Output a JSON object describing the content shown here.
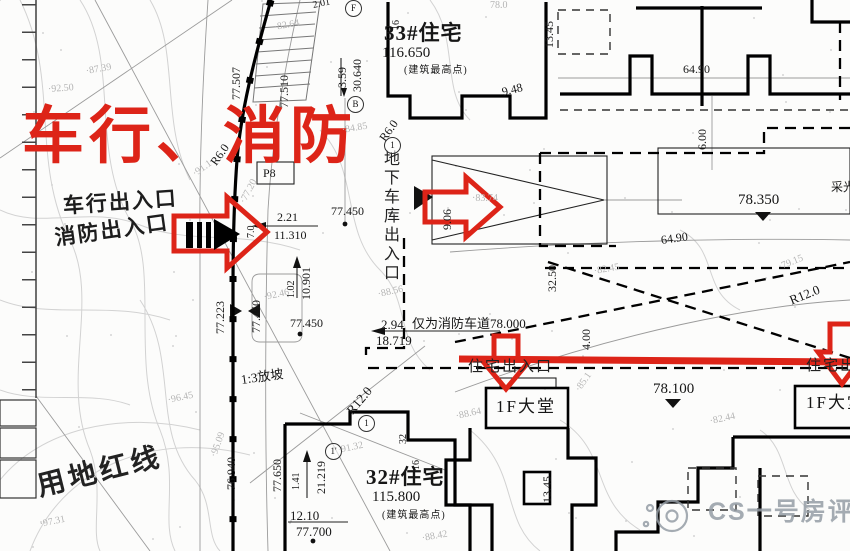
{
  "colors": {
    "accent_red": "#dd2418",
    "ink": "#111111",
    "faint_gray": "#b5b5b5",
    "contour_gray": "#d2d2d2",
    "watermark_gray": "#949ca4"
  },
  "labels": [
    {
      "n": "headline-vehicle-fire",
      "t": "车行、消防",
      "x": 22,
      "y": 106,
      "c": "red-head"
    },
    {
      "n": "note-vehicle-entrance",
      "t": "车行出入口",
      "x": 63,
      "y": 196,
      "c": "cn-hand",
      "r": -4
    },
    {
      "n": "note-fire-entrance",
      "t": "消防出入口",
      "x": 55,
      "y": 228,
      "c": "cn-hand",
      "r": -8
    },
    {
      "n": "building-33-title",
      "t": "33#住宅",
      "x": 384,
      "y": 23,
      "c": "title"
    },
    {
      "n": "building-33-elevation",
      "t": "116.650",
      "x": 382,
      "y": 46,
      "c": "dim-lg"
    },
    {
      "n": "building-33-note",
      "t": "(建筑最高点)",
      "x": 404,
      "y": 66,
      "c": "cn-s"
    },
    {
      "n": "building-32-title",
      "t": "32#住宅",
      "x": 366,
      "y": 467,
      "c": "title"
    },
    {
      "n": "building-32-elevation",
      "t": "115.800",
      "x": 372,
      "y": 490,
      "c": "dim-lg"
    },
    {
      "n": "building-32-note",
      "t": "(建筑最高点)",
      "x": 382,
      "y": 511,
      "c": "cn-s"
    },
    {
      "n": "lobby-left-label",
      "t": "1F大堂",
      "x": 496,
      "y": 398,
      "c": "cn-lobby"
    },
    {
      "n": "lobby-right-label",
      "t": "1F大堂",
      "x": 806,
      "y": 394,
      "c": "cn-lobby"
    },
    {
      "n": "residential-entrance-left",
      "t": "住宅出入口",
      "x": 468,
      "y": 360,
      "c": "cn-entry"
    },
    {
      "n": "residential-entrance-right",
      "t": "住宅出入口",
      "x": 806,
      "y": 359,
      "c": "cn-entry"
    },
    {
      "n": "garage-entrance-label",
      "t": "地下车库出入口",
      "x": 381,
      "y": 150,
      "c": "cn-vert"
    },
    {
      "n": "fire-lane-note",
      "t": "仅为消防车道78.000",
      "x": 412,
      "y": 317,
      "c": "dim-m"
    },
    {
      "n": "dim-2-94",
      "t": "2.94",
      "x": 381,
      "y": 318,
      "c": "dim-m"
    },
    {
      "n": "dim-18-719",
      "t": "18.719",
      "x": 376,
      "y": 334,
      "c": "dim-m"
    },
    {
      "n": "spot-77-450-a",
      "t": "77.450",
      "x": 331,
      "y": 205,
      "c": "dim"
    },
    {
      "n": "dim-2-21",
      "t": "2.21",
      "x": 277,
      "y": 211,
      "c": "dim"
    },
    {
      "n": "dim-11-310",
      "t": "11.310",
      "x": 274,
      "y": 229,
      "c": "dim"
    },
    {
      "n": "spot-77-450-b",
      "t": "77.450",
      "x": 290,
      "y": 317,
      "c": "dim"
    },
    {
      "n": "spot-78-350",
      "t": "78.350",
      "x": 738,
      "y": 193,
      "c": "dim-lg"
    },
    {
      "n": "spot-78-100",
      "t": "78.100",
      "x": 653,
      "y": 382,
      "c": "dim-lg"
    },
    {
      "n": "dim-64-90-top",
      "t": "64.90",
      "x": 683,
      "y": 63,
      "c": "dim"
    },
    {
      "n": "dim-64-90-mid",
      "t": "64.90",
      "x": 661,
      "y": 234,
      "c": "dim",
      "r": -8
    },
    {
      "n": "label-daylight-well",
      "t": "采光",
      "x": 831,
      "y": 181,
      "c": "cn-s2"
    },
    {
      "n": "dim-9-48",
      "t": "9.48",
      "x": 502,
      "y": 86,
      "c": "dim",
      "r": -14
    },
    {
      "n": "contour-78-0",
      "t": "78.0",
      "x": 490,
      "y": 1,
      "c": "faint"
    },
    {
      "n": "dim-2-01",
      "t": "2.01",
      "x": 313,
      "y": 1,
      "c": "dim-s",
      "r": -12
    },
    {
      "n": "label-p8",
      "t": "P8",
      "x": 263,
      "y": 167,
      "c": "dim"
    },
    {
      "n": "radius-r6-road",
      "t": "R6.0",
      "x": 213,
      "y": 158,
      "c": "dim",
      "r": -55
    },
    {
      "n": "radius-r6-upper",
      "t": "R6.0",
      "x": 382,
      "y": 134,
      "c": "dim",
      "r": -55
    },
    {
      "n": "slope-note",
      "t": "1:3放坡",
      "x": 241,
      "y": 373,
      "c": "cn-m",
      "r": -8
    },
    {
      "n": "radius-r12-left",
      "t": "R12.0",
      "x": 349,
      "y": 406,
      "c": "dim-m",
      "r": -50
    },
    {
      "n": "radius-r12-right",
      "t": "R12.0",
      "x": 790,
      "y": 294,
      "c": "dim-m",
      "r": -22
    },
    {
      "n": "land-red-line-label",
      "t": "用地红线",
      "x": 38,
      "y": 474,
      "c": "cn-big",
      "r": -14
    },
    {
      "n": "dim-12-10",
      "t": "12.10",
      "x": 290,
      "y": 509,
      "c": "dim-m"
    },
    {
      "n": "spot-77-700",
      "t": "77.700",
      "x": 296,
      "y": 525,
      "c": "dim-m"
    },
    {
      "n": "watermark-text",
      "t": "CS一号房评",
      "x": 708,
      "y": 500,
      "c": "wm"
    },
    {
      "n": "contour-82-64",
      "t": "·82.64",
      "x": 274,
      "y": 23,
      "c": "faint",
      "r": -10
    },
    {
      "n": "contour-87-39",
      "t": "·87.39",
      "x": 86,
      "y": 67,
      "c": "faint",
      "r": -10
    },
    {
      "n": "contour-92-50",
      "t": "·92.50",
      "x": 48,
      "y": 85,
      "c": "faint",
      "r": -4
    },
    {
      "n": "contour-91-1",
      "t": "·91.1",
      "x": 194,
      "y": 170,
      "c": "faint",
      "r": -35
    },
    {
      "n": "contour-84-85",
      "t": "·84.85",
      "x": 342,
      "y": 126,
      "c": "faint",
      "r": -10
    },
    {
      "n": "contour-83-74",
      "t": "·83.74",
      "x": 472,
      "y": 194,
      "c": "faint"
    },
    {
      "n": "contour-82-45",
      "t": "·82.45",
      "x": 594,
      "y": 267,
      "c": "faint",
      "r": -10
    },
    {
      "n": "contour-79-15",
      "t": "·79.15",
      "x": 779,
      "y": 263,
      "c": "faint",
      "r": -22
    },
    {
      "n": "contour-88-56",
      "t": "·88.56",
      "x": 378,
      "y": 290,
      "c": "faint",
      "r": -12
    },
    {
      "n": "contour-92-46",
      "t": "·92.46",
      "x": 264,
      "y": 293,
      "c": "faint",
      "r": -12
    },
    {
      "n": "contour-96-45",
      "t": "·96.45",
      "x": 168,
      "y": 396,
      "c": "faint",
      "r": -12
    },
    {
      "n": "contour-97-31",
      "t": "·97.31",
      "x": 40,
      "y": 520,
      "c": "faint",
      "r": -12
    },
    {
      "n": "contour-95-09",
      "t": "·95.09",
      "x": 214,
      "y": 452,
      "c": "faint",
      "r": -70
    },
    {
      "n": "contour-91-32",
      "t": "·91.32",
      "x": 338,
      "y": 446,
      "c": "faint",
      "r": -12
    },
    {
      "n": "contour-88-42",
      "t": "·88.42",
      "x": 422,
      "y": 534,
      "c": "faint",
      "r": -10
    },
    {
      "n": "contour-85-1",
      "t": "·85.1",
      "x": 578,
      "y": 386,
      "c": "faint",
      "r": -55
    },
    {
      "n": "contour-88-64",
      "t": "·88.64",
      "x": 456,
      "y": 412,
      "c": "faint",
      "r": -12
    },
    {
      "n": "contour-82-44",
      "t": "·82.44",
      "x": 710,
      "y": 417,
      "c": "faint",
      "r": -12
    },
    {
      "n": "contour-77-20",
      "t": "·77.20",
      "x": 243,
      "y": 198,
      "c": "faint",
      "r": -62
    },
    {
      "n": "dim-77-507",
      "t": "77.507",
      "x": 230,
      "y": 100,
      "c": "dim",
      "v": 1
    },
    {
      "n": "dim-77-510",
      "t": "77.510",
      "x": 278,
      "y": 108,
      "c": "dim",
      "v": 1
    },
    {
      "n": "dim-3-59",
      "t": "3.59",
      "x": 336,
      "y": 88,
      "c": "dim",
      "v": 1
    },
    {
      "n": "dim-30-640",
      "t": "30.640",
      "x": 351,
      "y": 92,
      "c": "dim",
      "v": 1
    },
    {
      "n": "dim-16-top",
      "t": "16",
      "x": 392,
      "y": 30,
      "c": "dim-s",
      "v": 1
    },
    {
      "n": "dim-13-45-top",
      "t": "13.45",
      "x": 543,
      "y": 48,
      "c": "dim",
      "v": 1
    },
    {
      "n": "dim-9-06",
      "t": "9.06",
      "x": 441,
      "y": 230,
      "c": "dim",
      "v": 1
    },
    {
      "n": "dim-7-0",
      "t": "7.0",
      "x": 247,
      "y": 238,
      "c": "dim-s",
      "v": 1
    },
    {
      "n": "dim-32-50",
      "t": "32.50",
      "x": 546,
      "y": 292,
      "c": "dim",
      "v": 1
    },
    {
      "n": "dim-6-00",
      "t": "6.00",
      "x": 696,
      "y": 150,
      "c": "dim",
      "v": 1
    },
    {
      "n": "dim-4-00",
      "t": "4.00",
      "x": 580,
      "y": 350,
      "c": "dim",
      "v": 1
    },
    {
      "n": "spot-77-450-road",
      "t": "77.450",
      "x": 250,
      "y": 333,
      "c": "dim",
      "v": 1
    },
    {
      "n": "spot-77-223",
      "t": "77.223",
      "x": 214,
      "y": 334,
      "c": "dim",
      "v": 1
    },
    {
      "n": "dim-1-02",
      "t": "1.02",
      "x": 287,
      "y": 298,
      "c": "dim-s",
      "v": 1
    },
    {
      "n": "dim-10-901",
      "t": "10.901",
      "x": 300,
      "y": 300,
      "c": "dim",
      "v": 1
    },
    {
      "n": "spot-77-650",
      "t": "77.650",
      "x": 271,
      "y": 492,
      "c": "dim",
      "v": 1
    },
    {
      "n": "dim-1-41",
      "t": "1.41",
      "x": 292,
      "y": 490,
      "c": "dim-s",
      "v": 1
    },
    {
      "n": "dim-21-219",
      "t": "21.219",
      "x": 315,
      "y": 494,
      "c": "dim",
      "v": 1
    },
    {
      "n": "spot-76-940",
      "t": "76.940",
      "x": 225,
      "y": 490,
      "c": "dim",
      "v": 1
    },
    {
      "n": "dim-13-45-bottom",
      "t": "13.45",
      "x": 541,
      "y": 503,
      "c": "dim",
      "v": 1
    },
    {
      "n": "dim-32",
      "t": "32",
      "x": 399,
      "y": 444,
      "c": "dim-s",
      "v": 1
    },
    {
      "n": "dim-16-bottom",
      "t": "16",
      "x": 412,
      "y": 470,
      "c": "dim-s",
      "v": 1
    },
    {
      "n": "ref-circle-1-top",
      "t": "1",
      "x": 384,
      "y": 137,
      "c": "circ"
    },
    {
      "n": "ref-circle-f",
      "t": "F",
      "x": 345,
      "y": 0,
      "c": "circ"
    },
    {
      "n": "ref-circle-b",
      "t": "B",
      "x": 347,
      "y": 96,
      "c": "circ"
    },
    {
      "n": "ref-circle-1-bottom",
      "t": "1",
      "x": 358,
      "y": 415,
      "c": "circ"
    },
    {
      "n": "ref-circle-1-prime",
      "t": "1'",
      "x": 325,
      "y": 443,
      "c": "circ"
    }
  ]
}
